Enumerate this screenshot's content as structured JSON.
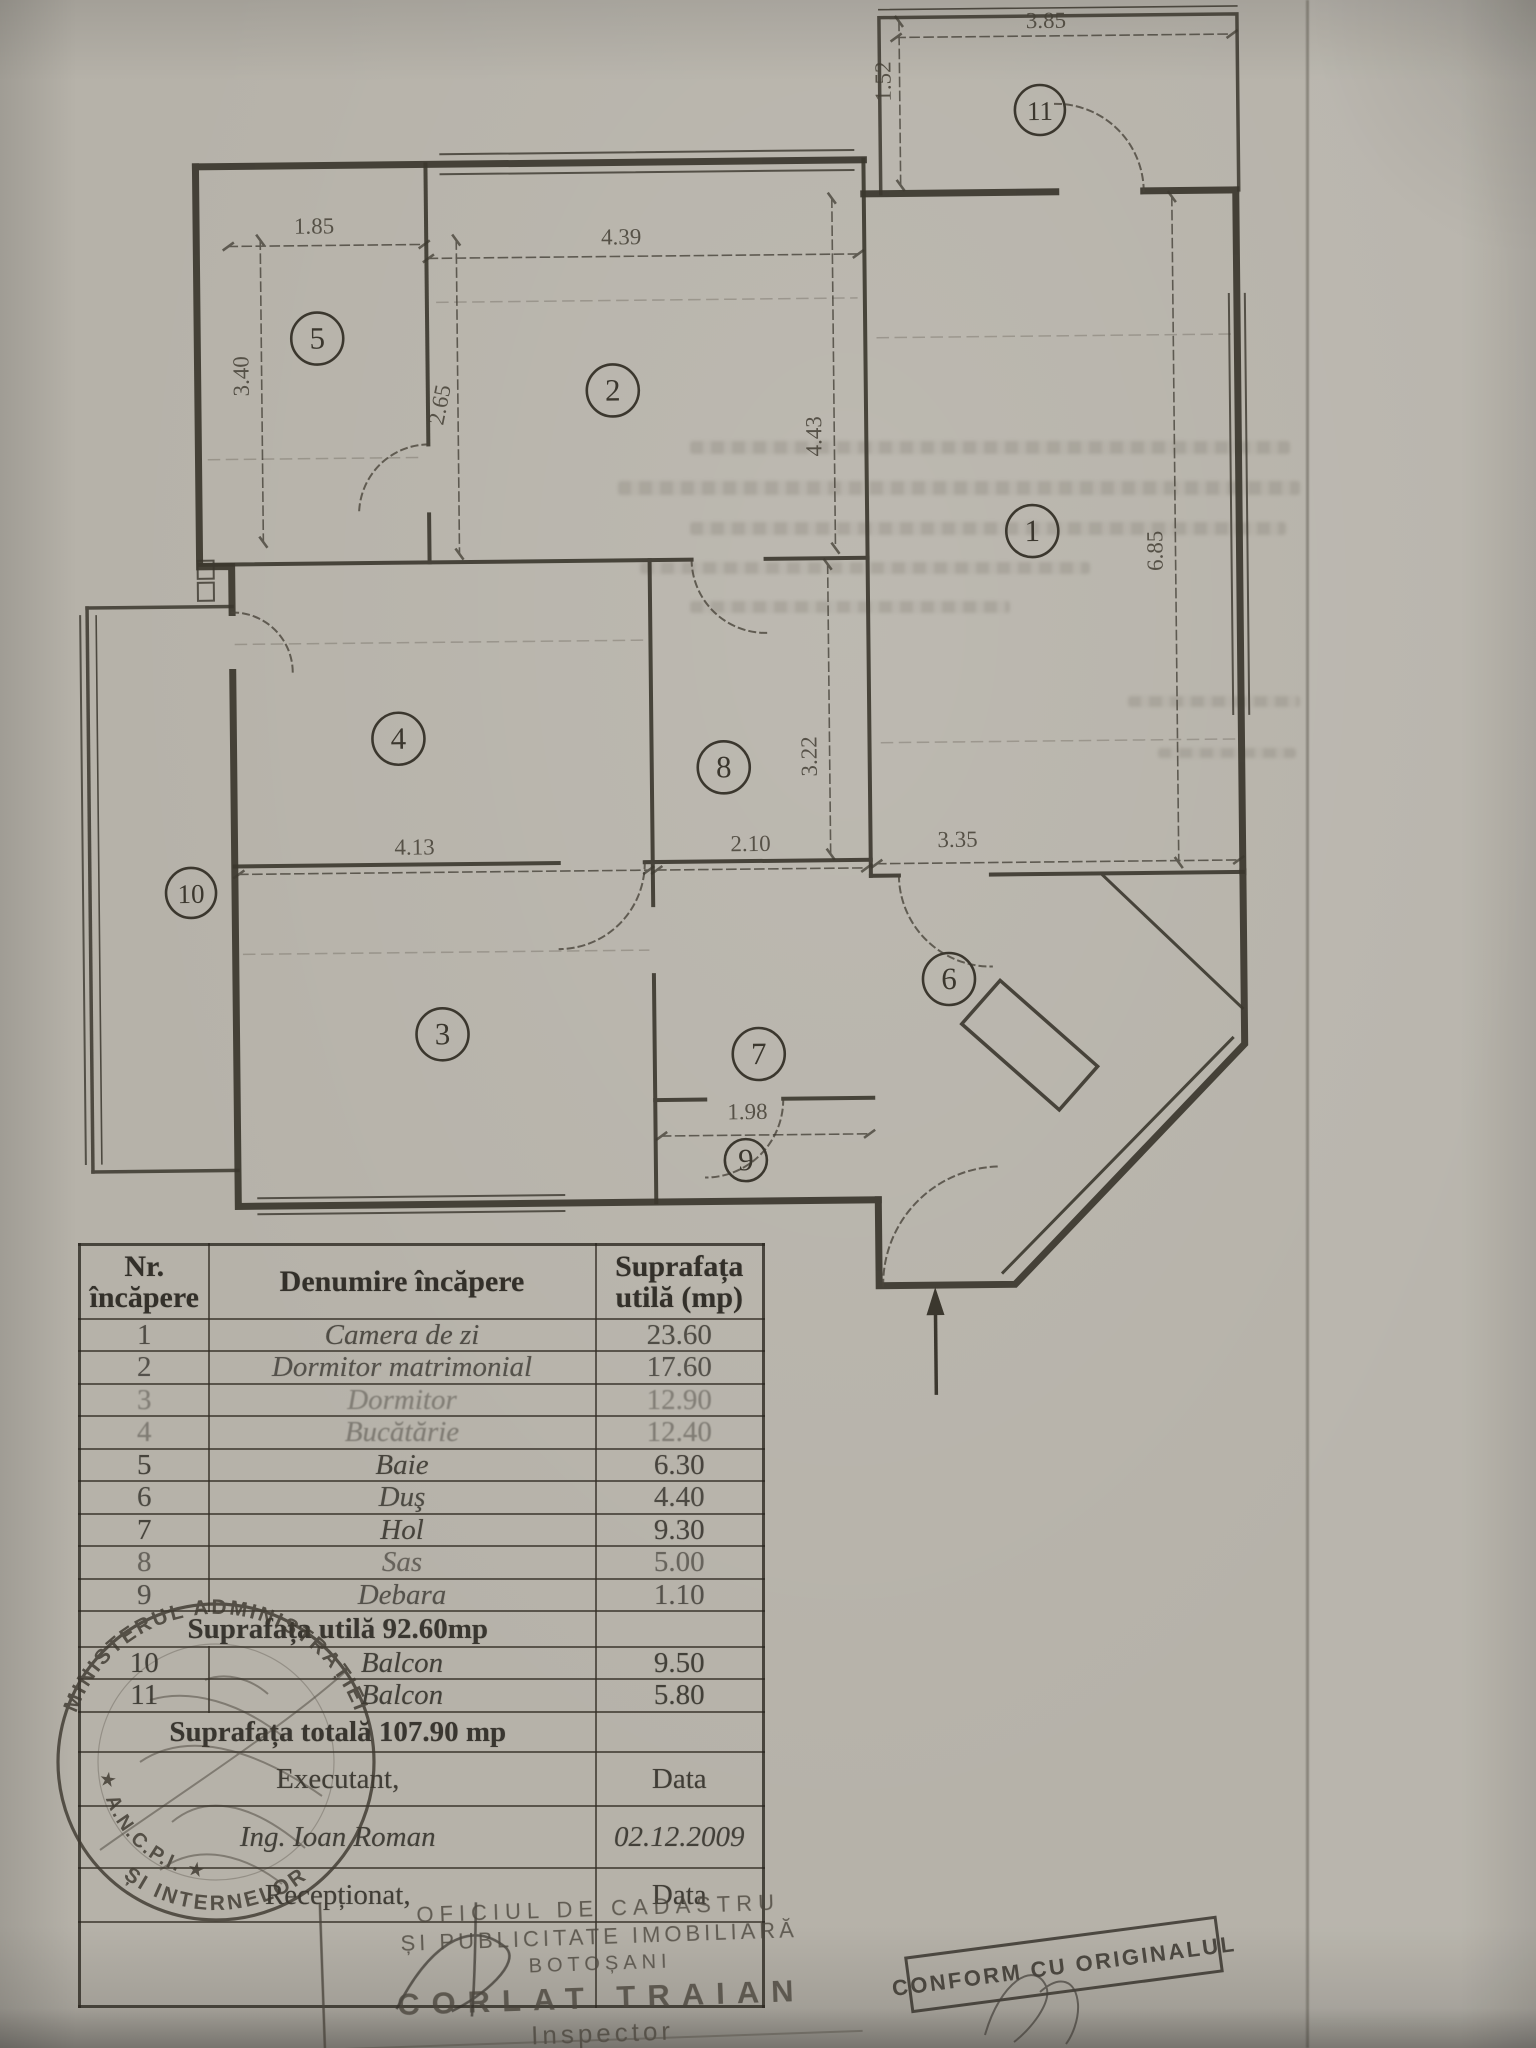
{
  "floor_plan": {
    "rooms": [
      {
        "n": "1",
        "x": 1033,
        "y": 535
      },
      {
        "n": "2",
        "x": 615,
        "y": 390
      },
      {
        "n": "3",
        "x": 438,
        "y": 1032
      },
      {
        "n": "4",
        "x": 397,
        "y": 736
      },
      {
        "n": "5",
        "x": 320,
        "y": 335
      },
      {
        "n": "6",
        "x": 945,
        "y": 982
      },
      {
        "n": "7",
        "x": 754,
        "y": 1055
      },
      {
        "n": "8",
        "x": 722,
        "y": 768
      },
      {
        "n": "9",
        "x": 740,
        "y": 1161
      },
      {
        "n": "10",
        "x": 188,
        "y": 888
      },
      {
        "n": "11",
        "x": 1045,
        "y": 114
      }
    ],
    "dimensions": [
      {
        "t": "3.85",
        "x": 1052,
        "y": 32,
        "r": 0
      },
      {
        "t": "1.52",
        "x": 896,
        "y": 84,
        "r": -90
      },
      {
        "t": "1.85",
        "x": 318,
        "y": 230,
        "r": 0
      },
      {
        "t": "4.39",
        "x": 625,
        "y": 244,
        "r": 0
      },
      {
        "t": "3.40",
        "x": 251,
        "y": 372,
        "r": -90
      },
      {
        "t": "2.65",
        "x": 449,
        "y": 404,
        "r": -78
      },
      {
        "t": "4.43",
        "x": 823,
        "y": 438,
        "r": -90
      },
      {
        "t": "6.85",
        "x": 1163,
        "y": 556,
        "r": -90
      },
      {
        "t": "4.13",
        "x": 412,
        "y": 852,
        "r": 0
      },
      {
        "t": "2.10",
        "x": 748,
        "y": 852,
        "r": 0
      },
      {
        "t": "3.35",
        "x": 955,
        "y": 850,
        "r": 0
      },
      {
        "t": "3.22",
        "x": 815,
        "y": 758,
        "r": -90
      },
      {
        "t": "1.98",
        "x": 742,
        "y": 1120,
        "r": 0
      }
    ]
  },
  "table": {
    "header": {
      "col1a": "Nr.",
      "col1b": "încăpere",
      "col2": "Denumire încăpere",
      "col3a": "Suprafața",
      "col3b": "utilă (mp)"
    },
    "rows": [
      {
        "nr": "1",
        "name": "Camera de zi",
        "area": "23.60",
        "fade": 0.78
      },
      {
        "nr": "2",
        "name": "Dormitor matrimonial",
        "area": "17.60",
        "fade": 0.74
      },
      {
        "nr": "3",
        "name": "Dormitor",
        "area": "12.90",
        "fade": 0.4
      },
      {
        "nr": "4",
        "name": "Bucătărie",
        "area": "12.40",
        "fade": 0.42
      },
      {
        "nr": "5",
        "name": "Baie",
        "area": "6.30",
        "fade": 0.85
      },
      {
        "nr": "6",
        "name": "Duş",
        "area": "4.40",
        "fade": 0.8
      },
      {
        "nr": "7",
        "name": "Hol",
        "area": "9.30",
        "fade": 0.85
      },
      {
        "nr": "8",
        "name": "Sas",
        "area": "5.00",
        "fade": 0.6
      },
      {
        "nr": "9",
        "name": "Debara",
        "area": "1.10",
        "fade": 0.74
      }
    ],
    "summary_utila": "Suprafața utilă 92.60mp",
    "balcon_rows": [
      {
        "nr": "10",
        "name": "Balcon",
        "area": "9.50",
        "fade": 0.88
      },
      {
        "nr": "11",
        "name": "Balcon",
        "area": "5.80",
        "fade": 0.88
      }
    ],
    "summary_totala": "Suprafața totală 107.90 mp",
    "footer": {
      "executant": "Executant,",
      "data_label_1": "Data",
      "name": "Ing. Ioan Roman",
      "date": "02.12.2009",
      "receptionat": "Recepționat,",
      "data_label_2": "Data"
    }
  },
  "stamps": {
    "round": {
      "text_top": "MINISTERUL ADMINISTRAȚIEI",
      "text_bottom": "ȘI INTERNELOR",
      "text_left": "★ A.N.C.P.I. ★"
    },
    "cadastru": {
      "line1": "OFICIUL DE CADASTRU",
      "line2": "ȘI PUBLICITATE IMOBILIARĂ",
      "line3": "BOTOȘANI",
      "name": "CORLAT TRAIAN",
      "role": "Inspector"
    },
    "conform": {
      "text": "CONFORM CU ORIGINALUL"
    }
  }
}
